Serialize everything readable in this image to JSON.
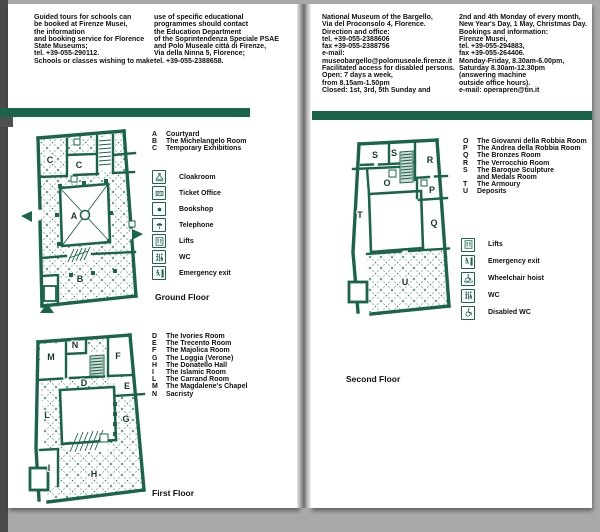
{
  "colors": {
    "accent_green": "#1a6549",
    "map_pattern_green": "#3d8165",
    "text_black": "#111111",
    "backdrop_gray": "#a9a9a9"
  },
  "left_page": {
    "intro_col1": "Guided tours for schools can\nbe booked at Firenze Musei,\nthe information\nand booking service for Florence\nState Museums;\ntel. +39-055-290112.\nSchools or classes wishing to make",
    "intro_col2": "use of specific educational\nprogrammes should contact\nthe Education Department\nof the Soprintendenza Speciale PSAE\nand Polo Museale città di Firenze,\nVia della Ninna 5, Florence;\ntel. +39-055-2388658.",
    "ground_floor": {
      "label": "Ground Floor",
      "rooms": [
        {
          "letter": "A",
          "name": "Courtyard"
        },
        {
          "letter": "B",
          "name": "The Michelangelo Room"
        },
        {
          "letter": "C",
          "name": "Temporary Exhibitions"
        }
      ],
      "facilities": [
        {
          "icon": "cloakroom-icon",
          "label": "Cloakroom"
        },
        {
          "icon": "ticket-office-icon",
          "label": "Ticket Office"
        },
        {
          "icon": "bookshop-icon",
          "label": "Bookshop"
        },
        {
          "icon": "telephone-icon",
          "label": "Telephone"
        },
        {
          "icon": "lifts-icon",
          "label": "Lifts"
        },
        {
          "icon": "wc-icon",
          "label": "WC"
        },
        {
          "icon": "emergency-exit-icon",
          "label": "Emergency exit"
        }
      ]
    },
    "first_floor": {
      "label": "First Floor",
      "rooms": [
        {
          "letter": "D",
          "name": "The Ivories Room"
        },
        {
          "letter": "E",
          "name": "The Trecento Room"
        },
        {
          "letter": "F",
          "name": "The Majolica Room"
        },
        {
          "letter": "G",
          "name": "The Loggia (Verone)"
        },
        {
          "letter": "H",
          "name": "The Donatello Hall"
        },
        {
          "letter": "I",
          "name": "The Islamic Room"
        },
        {
          "letter": "L",
          "name": "The Carrand Room"
        },
        {
          "letter": "M",
          "name": "The Magdalene's Chapel"
        },
        {
          "letter": "N",
          "name": "Sacristy"
        }
      ]
    }
  },
  "right_page": {
    "info_col1": "National Museum of the Bargello,\nVia del Proconsolo 4, Florence.\nDirection and office:\ntel. +39-055-2388606\nfax +39-055-2388756\ne-mail:\nmuseobargello@polomuseale.firenze.it\nFacilitated access for disabled persons.\nOpen: 7 days a week,\nfrom 8.15am-1.50pm\nClosed: 1st, 3rd, 5th Sunday and",
    "info_col2": "2nd and 4th Monday of every month,\nNew Year's Day, 1 May, Christmas Day.\nBookings and information:\nFirenze Musei,\ntel. +39-055-294883,\nfax +39-055-264406.\nMonday-Friday, 8.30am-6.00pm,\nSaturday 8.30am-12.30pm\n(answering machine\noutside office hours).\ne-mail: operapren@tin.it",
    "second_floor": {
      "label": "Second Floor",
      "rooms": [
        {
          "letter": "O",
          "name": "The Giovanni della Robbia Room"
        },
        {
          "letter": "P",
          "name": "The Andrea della Robbia Room"
        },
        {
          "letter": "Q",
          "name": "The Bronzes Room"
        },
        {
          "letter": "R",
          "name": "The Verrocchio Room"
        },
        {
          "letter": "S",
          "name": "The Baroque Sculpture\nand Medals Room"
        },
        {
          "letter": "T",
          "name": "The Armoury"
        },
        {
          "letter": "U",
          "name": "Deposits"
        }
      ],
      "facilities": [
        {
          "icon": "lifts-icon",
          "label": "Lifts"
        },
        {
          "icon": "emergency-exit-icon",
          "label": "Emergency exit"
        },
        {
          "icon": "wheelchair-hoist-icon",
          "label": "Wheelchair hoist"
        },
        {
          "icon": "wc-icon",
          "label": "WC"
        },
        {
          "icon": "disabled-wc-icon",
          "label": "Disabled WC"
        }
      ]
    }
  }
}
